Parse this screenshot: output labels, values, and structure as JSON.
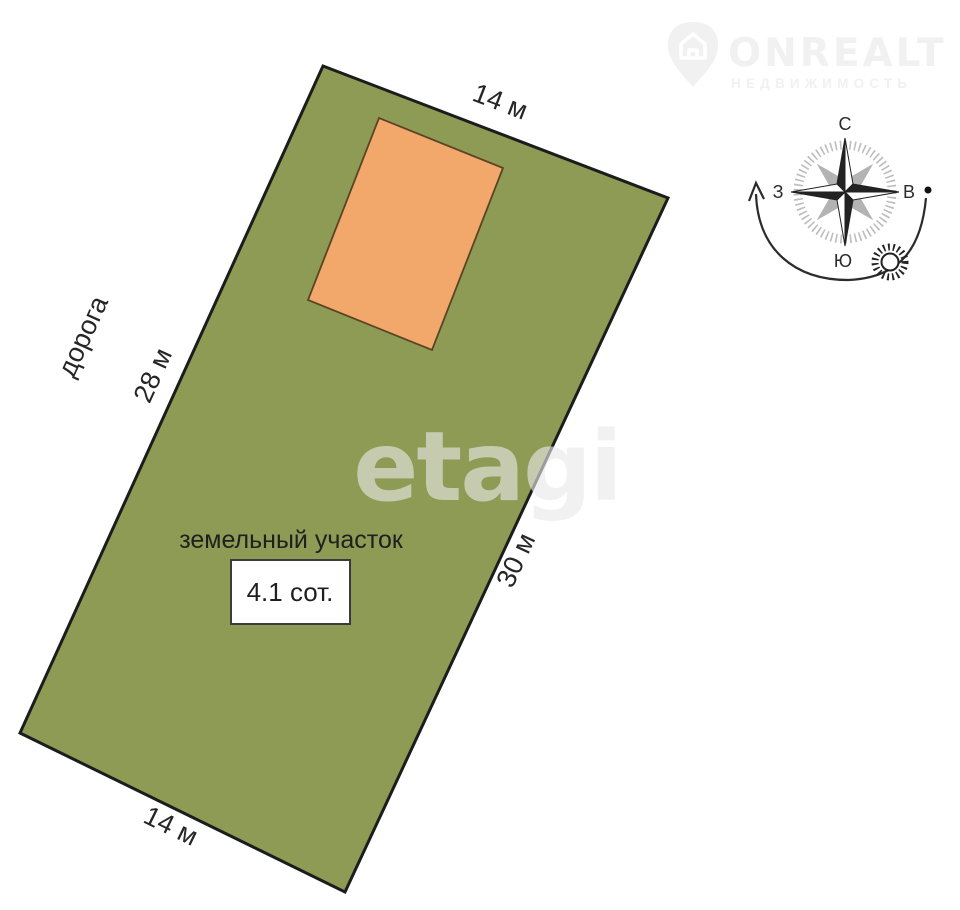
{
  "logo": {
    "title": "ONREALT",
    "subtitle": "НЕДВИЖИМОСТЬ",
    "color": "#f1f1f1"
  },
  "watermark": {
    "text": "etagi",
    "color": "#e9e9e9"
  },
  "compass": {
    "north": "С",
    "south": "Ю",
    "west": "З",
    "east": "В"
  },
  "plot": {
    "title": "земельный участок",
    "area": "4.1 сот.",
    "top_length": "14 м",
    "bottom_length": "14 м",
    "left_length": "28 м",
    "right_length": "30 м",
    "road_label": "дорога"
  },
  "colors": {
    "plot_fill": "#8d9b54",
    "plot_stroke": "#1c1c1c",
    "building_fill": "#f2a76b",
    "building_stroke": "#5b4426",
    "box_fill": "#ffffff",
    "box_stroke": "#3b3b3b",
    "compass_gray": "#b3b3b3",
    "compass_dark": "#222222",
    "tick_ring": "#bdbdbd"
  }
}
